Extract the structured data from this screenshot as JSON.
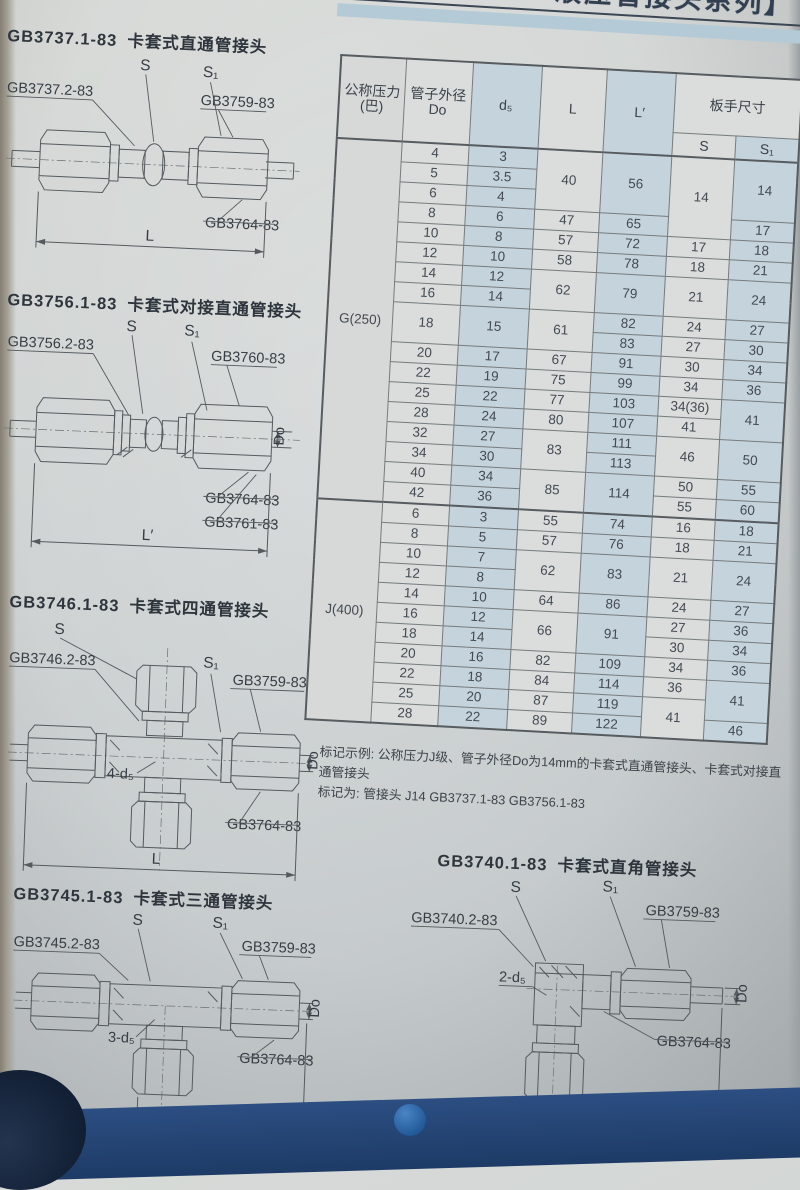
{
  "banner": {
    "title": "液压管接头系列】"
  },
  "diagrams": [
    {
      "code": "GB3737.1-83",
      "name": "卡套式直通管接头",
      "labels": {
        "s": "S",
        "s1": "S₁",
        "body": "GB3737.2-83",
        "nut": "GB3759-83",
        "ferrule": "GB3764-83",
        "dim": "L"
      }
    },
    {
      "code": "GB3756.1-83",
      "name": "卡套式对接直通管接头",
      "labels": {
        "body": "GB3756.2-83",
        "s": "S",
        "s1": "S₁",
        "nut": "GB3760-83",
        "od": "Do",
        "ferrule": "GB3764-83",
        "ferrule2": "GB3761-83",
        "dim": "L′"
      }
    },
    {
      "code": "GB3746.1-83",
      "name": "卡套式四通管接头",
      "labels": {
        "s": "S",
        "body": "GB3746.2-83",
        "s1": "S₁",
        "nut": "GB3759-83",
        "holes": "4-d₅",
        "od": "Do",
        "ferrule": "GB3764-83",
        "dim": "L"
      }
    },
    {
      "code": "GB3745.1-83",
      "name": "卡套式三通管接头",
      "labels": {
        "s": "S",
        "body": "GB3745.2-83",
        "s1": "S₁",
        "nut": "GB3759-83",
        "holes": "3-d₅",
        "od": "Do",
        "ferrule": "GB3764-83",
        "dim": "L"
      }
    },
    {
      "code": "GB3740.1-83",
      "name": "卡套式直角管接头",
      "labels": {
        "s": "S",
        "s1": "S₁",
        "body": "GB3740.2-83",
        "nut": "GB3759-83",
        "holes": "2-d₅",
        "od": "Do",
        "ferrule": "GB3764-83",
        "dim": "L"
      }
    }
  ],
  "table": {
    "headers": {
      "col1a": "公称压力",
      "col1b": "(巴)",
      "col2a": "管子外径",
      "col2b": "Do",
      "d5": "d₅",
      "L": "L",
      "Lp": "L′",
      "wrench": "板手尺寸",
      "S": "S",
      "S1": "S₁"
    },
    "sections": [
      {
        "group": "G(250)",
        "rows": [
          [
            {
              "c": "grp",
              "v": "G(250)",
              "rs": 18
            },
            {
              "c": "do",
              "v": "4"
            },
            {
              "c": "d5",
              "v": "3"
            },
            {
              "c": "L",
              "v": "40",
              "rs": 3
            },
            {
              "c": "Lp",
              "v": "56",
              "rs": 3
            },
            {
              "c": "S",
              "v": "14",
              "rs": 4
            },
            {
              "c": "S1",
              "v": "14",
              "rs": 3
            }
          ],
          [
            {
              "c": "do",
              "v": "5"
            },
            {
              "c": "d5",
              "v": "3.5"
            }
          ],
          [
            {
              "c": "do",
              "v": "6"
            },
            {
              "c": "d5",
              "v": "4"
            }
          ],
          [
            {
              "c": "do",
              "v": "8"
            },
            {
              "c": "d5",
              "v": "6"
            },
            {
              "c": "L",
              "v": "47"
            },
            {
              "c": "Lp",
              "v": "65"
            },
            {
              "c": "S1",
              "v": "17"
            }
          ],
          [
            {
              "c": "do",
              "v": "10"
            },
            {
              "c": "d5",
              "v": "8"
            },
            {
              "c": "L",
              "v": "57"
            },
            {
              "c": "Lp",
              "v": "72"
            },
            {
              "c": "S",
              "v": "17"
            },
            {
              "c": "S1",
              "v": "18"
            }
          ],
          [
            {
              "c": "do",
              "v": "12"
            },
            {
              "c": "d5",
              "v": "10"
            },
            {
              "c": "L",
              "v": "58"
            },
            {
              "c": "Lp",
              "v": "78"
            },
            {
              "c": "S",
              "v": "18"
            },
            {
              "c": "S1",
              "v": "21"
            }
          ],
          [
            {
              "c": "do",
              "v": "14"
            },
            {
              "c": "d5",
              "v": "12"
            },
            {
              "c": "L",
              "v": "62",
              "rs": 2
            },
            {
              "c": "Lp",
              "v": "79",
              "rs": 2
            },
            {
              "c": "S",
              "v": "21",
              "rs": 2
            },
            {
              "c": "S1",
              "v": "24",
              "rs": 2
            }
          ],
          [
            {
              "c": "do",
              "v": "16"
            },
            {
              "c": "d5",
              "v": "14"
            }
          ],
          [
            {
              "c": "do",
              "v": "18",
              "rs": 2
            },
            {
              "c": "d5",
              "v": "15",
              "rs": 2
            },
            {
              "c": "L",
              "v": "61",
              "rs": 2
            },
            {
              "c": "Lp",
              "v": "82"
            },
            {
              "c": "S",
              "v": "24"
            },
            {
              "c": "S1",
              "v": "27"
            }
          ],
          [
            {
              "c": "Lp",
              "v": "83"
            },
            {
              "c": "S",
              "v": "27"
            },
            {
              "c": "S1",
              "v": "30"
            }
          ],
          [
            {
              "c": "do",
              "v": "20"
            },
            {
              "c": "d5",
              "v": "17"
            },
            {
              "c": "L",
              "v": "67"
            },
            {
              "c": "Lp",
              "v": "91"
            },
            {
              "c": "S",
              "v": "30"
            },
            {
              "c": "S1",
              "v": "34"
            }
          ],
          [
            {
              "c": "do",
              "v": "22"
            },
            {
              "c": "d5",
              "v": "19"
            },
            {
              "c": "L",
              "v": "75"
            },
            {
              "c": "Lp",
              "v": "99"
            },
            {
              "c": "S",
              "v": "34"
            },
            {
              "c": "S1",
              "v": "36"
            }
          ],
          [
            {
              "c": "do",
              "v": "25"
            },
            {
              "c": "d5",
              "v": "22"
            },
            {
              "c": "L",
              "v": "77"
            },
            {
              "c": "Lp",
              "v": "103"
            },
            {
              "c": "S",
              "v": "34(36)"
            },
            {
              "c": "S1",
              "v": "41",
              "rs": 2
            }
          ],
          [
            {
              "c": "do",
              "v": "28"
            },
            {
              "c": "d5",
              "v": "24"
            },
            {
              "c": "L",
              "v": "80"
            },
            {
              "c": "Lp",
              "v": "107"
            },
            {
              "c": "S",
              "v": "41"
            }
          ],
          [
            {
              "c": "do",
              "v": "32"
            },
            {
              "c": "d5",
              "v": "27"
            },
            {
              "c": "L",
              "v": "83",
              "rs": 2
            },
            {
              "c": "Lp",
              "v": "111"
            },
            {
              "c": "S",
              "v": "46",
              "rs": 2
            },
            {
              "c": "S1",
              "v": "50",
              "rs": 2
            }
          ],
          [
            {
              "c": "do",
              "v": "34"
            },
            {
              "c": "d5",
              "v": "30"
            },
            {
              "c": "Lp",
              "v": "113"
            }
          ],
          [
            {
              "c": "do",
              "v": "40"
            },
            {
              "c": "d5",
              "v": "34"
            },
            {
              "c": "L",
              "v": "85",
              "rs": 2
            },
            {
              "c": "Lp",
              "v": "114",
              "rs": 2
            },
            {
              "c": "S",
              "v": "50"
            },
            {
              "c": "S1",
              "v": "55"
            }
          ],
          [
            {
              "c": "do",
              "v": "42"
            },
            {
              "c": "d5",
              "v": "36"
            },
            {
              "c": "S",
              "v": "55"
            },
            {
              "c": "S1",
              "v": "60"
            }
          ]
        ]
      },
      {
        "group": "J(400)",
        "rows": [
          [
            {
              "c": "grp",
              "v": "J(400)",
              "rs": 11
            },
            {
              "c": "do",
              "v": "6"
            },
            {
              "c": "d5",
              "v": "3"
            },
            {
              "c": "L",
              "v": "55"
            },
            {
              "c": "Lp",
              "v": "74"
            },
            {
              "c": "S",
              "v": "16"
            },
            {
              "c": "S1",
              "v": "18"
            }
          ],
          [
            {
              "c": "do",
              "v": "8"
            },
            {
              "c": "d5",
              "v": "5"
            },
            {
              "c": "L",
              "v": "57"
            },
            {
              "c": "Lp",
              "v": "76"
            },
            {
              "c": "S",
              "v": "18"
            },
            {
              "c": "S1",
              "v": "21"
            }
          ],
          [
            {
              "c": "do",
              "v": "10"
            },
            {
              "c": "d5",
              "v": "7"
            },
            {
              "c": "L",
              "v": "62",
              "rs": 2
            },
            {
              "c": "Lp",
              "v": "83",
              "rs": 2
            },
            {
              "c": "S",
              "v": "21",
              "rs": 2
            },
            {
              "c": "S1",
              "v": "24",
              "rs": 2
            }
          ],
          [
            {
              "c": "do",
              "v": "12"
            },
            {
              "c": "d5",
              "v": "8"
            }
          ],
          [
            {
              "c": "do",
              "v": "14"
            },
            {
              "c": "d5",
              "v": "10"
            },
            {
              "c": "L",
              "v": "64"
            },
            {
              "c": "Lp",
              "v": "86"
            },
            {
              "c": "S",
              "v": "24"
            },
            {
              "c": "S1",
              "v": "27"
            }
          ],
          [
            {
              "c": "do",
              "v": "16"
            },
            {
              "c": "d5",
              "v": "12"
            },
            {
              "c": "L",
              "v": "66",
              "rs": 2
            },
            {
              "c": "Lp",
              "v": "91",
              "rs": 2
            },
            {
              "c": "S",
              "v": "27"
            },
            {
              "c": "S1",
              "v": "36"
            }
          ],
          [
            {
              "c": "do",
              "v": "18"
            },
            {
              "c": "d5",
              "v": "14"
            },
            {
              "c": "S",
              "v": "30"
            },
            {
              "c": "S1",
              "v": "34"
            }
          ],
          [
            {
              "c": "do",
              "v": "20"
            },
            {
              "c": "d5",
              "v": "16"
            },
            {
              "c": "L",
              "v": "82"
            },
            {
              "c": "Lp",
              "v": "109"
            },
            {
              "c": "S",
              "v": "34"
            },
            {
              "c": "S1",
              "v": "36"
            }
          ],
          [
            {
              "c": "do",
              "v": "22"
            },
            {
              "c": "d5",
              "v": "18"
            },
            {
              "c": "L",
              "v": "84"
            },
            {
              "c": "Lp",
              "v": "114"
            },
            {
              "c": "S",
              "v": "36"
            },
            {
              "c": "S1",
              "v": "41",
              "rs": 2
            }
          ],
          [
            {
              "c": "do",
              "v": "25"
            },
            {
              "c": "d5",
              "v": "20"
            },
            {
              "c": "L",
              "v": "87"
            },
            {
              "c": "Lp",
              "v": "119"
            },
            {
              "c": "S",
              "v": "41",
              "rs": 2
            }
          ],
          [
            {
              "c": "do",
              "v": "28"
            },
            {
              "c": "d5",
              "v": "22"
            },
            {
              "c": "L",
              "v": "89"
            },
            {
              "c": "Lp",
              "v": "122"
            },
            {
              "c": "S1",
              "v": "46"
            }
          ]
        ]
      }
    ]
  },
  "notes": {
    "line1": "标记示例: 公称压力J级、管子外径Do为14mm的卡套式直通管接头、卡套式对接直通管接头",
    "line2": "标记为: 管接头 J14  GB3737.1-83   GB3756.1-83"
  }
}
